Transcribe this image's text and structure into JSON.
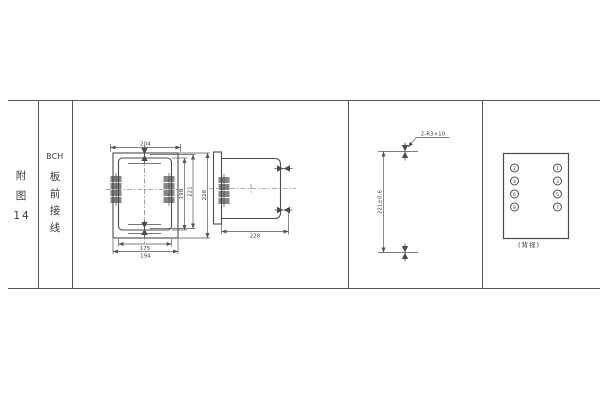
{
  "page": {
    "background": "#ffffff",
    "line_color": "#4b4b4b",
    "thin_line_color": "#5a5a5a",
    "text_color": "#3a3a3a"
  },
  "index_column": {
    "char_1": "附",
    "char_2": "图",
    "number": "14"
  },
  "title_column": {
    "model": "BCH",
    "char_1": "板",
    "char_2": "前",
    "char_3": "接",
    "char_4": "线"
  },
  "front_view": {
    "dim_width_top": "204",
    "dim_height_inner": "196",
    "dim_height_mid": "221",
    "dim_height_outer": "228",
    "dim_width_bottom_inner": "175",
    "dim_width_bottom_outer": "194"
  },
  "side_view": {
    "dim_depth": "228"
  },
  "drill_view": {
    "hole_callout": "2-R3×10",
    "dim_hole_spacing": "221±0.6"
  },
  "terminal_view": {
    "left": [
      "2",
      "4",
      "6",
      "8"
    ],
    "right": [
      "1",
      "3",
      "5",
      "7"
    ],
    "caption": "(背视)"
  }
}
